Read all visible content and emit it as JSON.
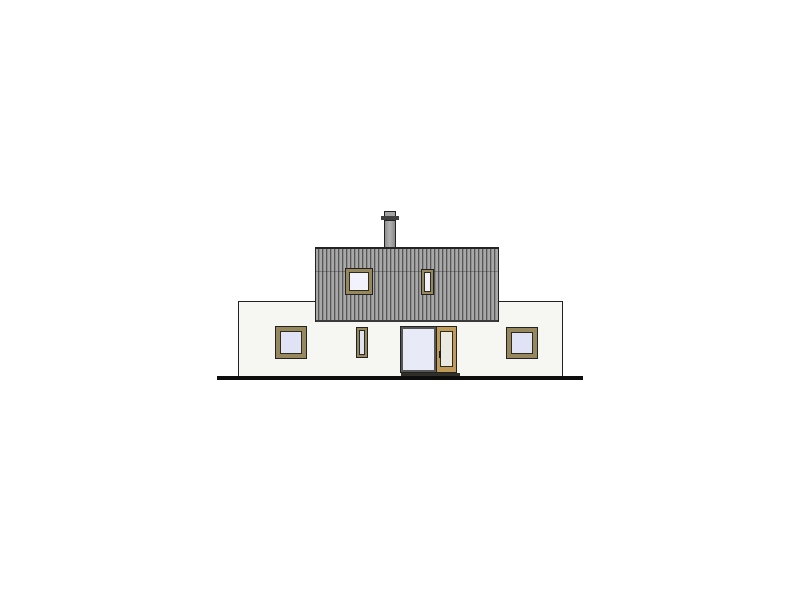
{
  "drawing": {
    "kind": "architectural-elevation",
    "elements": {
      "ground_line": "ground line",
      "lower_facade": "ground-floor facade",
      "upper_volume": "timber-clad upper storey",
      "chimney": "chimney",
      "windows": [
        "upper square window",
        "upper narrow window",
        "lower left window",
        "lower middle narrow window",
        "lower right window"
      ],
      "door": "glazed entry door with sidelight"
    }
  },
  "colors": {
    "background": "#ffffff",
    "facade": "#f6f6f3",
    "outline": "#222222",
    "cladding_light": "#a8a8a8",
    "cladding_mid": "#8f8f8f",
    "cladding_dark": "#565656",
    "cladding_edge": "#3a3a3a",
    "roof_edge": "#242424",
    "frame_olive": "#97875d",
    "frame_tan": "#c09a58",
    "frame_inner": "#2b2b20",
    "glass": "#e0e2f5",
    "glass_light": "#f1f2fb",
    "door_gray": "#565656",
    "door_panel": "#eae9e2",
    "chimney": "#a2a2a2",
    "chimney_cap": "#3f3f3f",
    "ground": "#0d0d0d",
    "threshold": "#2f2f28"
  }
}
